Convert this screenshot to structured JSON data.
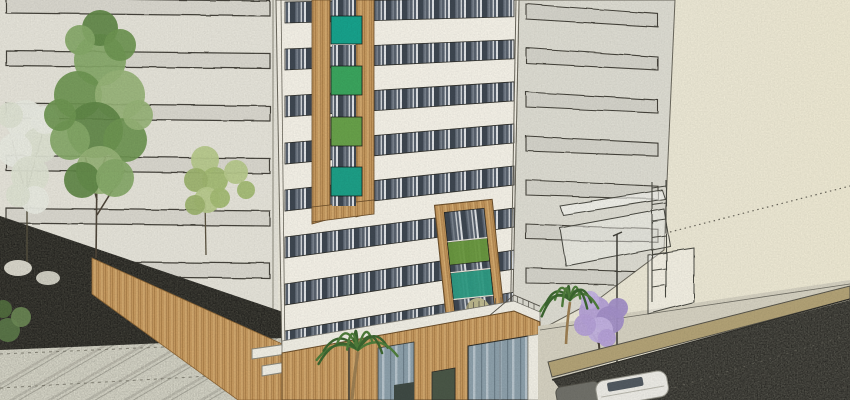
{
  "scene": {
    "title": "Sketch-style 3D architectural rendering of a mid-rise residential tower with ribbon windows and wood-framed green accent panels, seen from a street corner with plaza, palms, flowering trees and a dark asphalt road",
    "style": "hand-sketch watercolor render (SketchUp-like)",
    "setting": "urban street corner"
  },
  "palette": {
    "sky-left": "#e7e5dc",
    "sky-right": "#ede8d2",
    "ink": "#44433a",
    "left-facade": "#e5e3d9",
    "tower-front": "#f4f1e7",
    "tower-side": "#dddcd2",
    "glass-dark": "#59626e",
    "mullion": "#dfe2e5",
    "wood": "#c69a60",
    "wood-line": "#a87c45",
    "pavement": "#d9d8ca",
    "sidewalk": "#d5d1c1",
    "road": "#56554d",
    "dark-roof": "#45443c",
    "curb-wall": "#b3a377",
    "canopy-white": "#f0eee4",
    "palm-green": "#4f7d3b",
    "palm-dark": "#3c6630",
    "tree-green": "#86a868",
    "blossom-pale": "#e8eae0",
    "jacaranda-purple": "#b4a0d6",
    "shrub-red": "#a4594e",
    "shrub-olive": "#c0bb8e",
    "car-white": "#ecebe5",
    "car-gray": "#71716a",
    "glazing": "#8da0ab",
    "trunk-brown": "#9c7e52"
  },
  "tower": {
    "front_window_bands": 8,
    "side_window_bands": 7,
    "left_building_bands": 7,
    "upper_frame_panels": [
      {
        "color": "#17a28c",
        "y": 16,
        "h": 28
      },
      {
        "color": "#3ba55e",
        "y": 66,
        "h": 29
      },
      {
        "color": "#68a14a",
        "y": 117,
        "h": 29
      },
      {
        "color": "#1d9f87",
        "y": 167,
        "h": 29
      }
    ],
    "upper_frame_gaps": [
      [
        0,
        16
      ],
      [
        45,
        21
      ],
      [
        96,
        21
      ],
      [
        147,
        20
      ],
      [
        197,
        9
      ]
    ],
    "lower_frame_panels": [
      {
        "color": "#6b9a3f",
        "y": 240,
        "h": 23
      },
      {
        "color": "#2f9d85",
        "y": 271,
        "h": 27
      }
    ]
  },
  "vegetation": [
    {
      "type": "blossom-tree",
      "position": "far-left"
    },
    {
      "type": "deciduous-tree",
      "position": "left"
    },
    {
      "type": "lime-tree",
      "position": "left"
    },
    {
      "type": "palm",
      "position": "plaza-center"
    },
    {
      "type": "palm",
      "position": "sidewalk-right"
    },
    {
      "type": "jacaranda",
      "position": "sidewalk-right"
    },
    {
      "type": "shrub-red",
      "position": "terrace"
    },
    {
      "type": "shrub-olive",
      "position": "terrace"
    }
  ],
  "street": {
    "vehicles": [
      {
        "type": "hatchback",
        "color": "#ecebe5"
      },
      {
        "type": "car",
        "color": "#71716a"
      }
    ],
    "furniture": [
      "streetlight",
      "streetlight"
    ],
    "guideline": "dotted sketch leader line in sky"
  }
}
